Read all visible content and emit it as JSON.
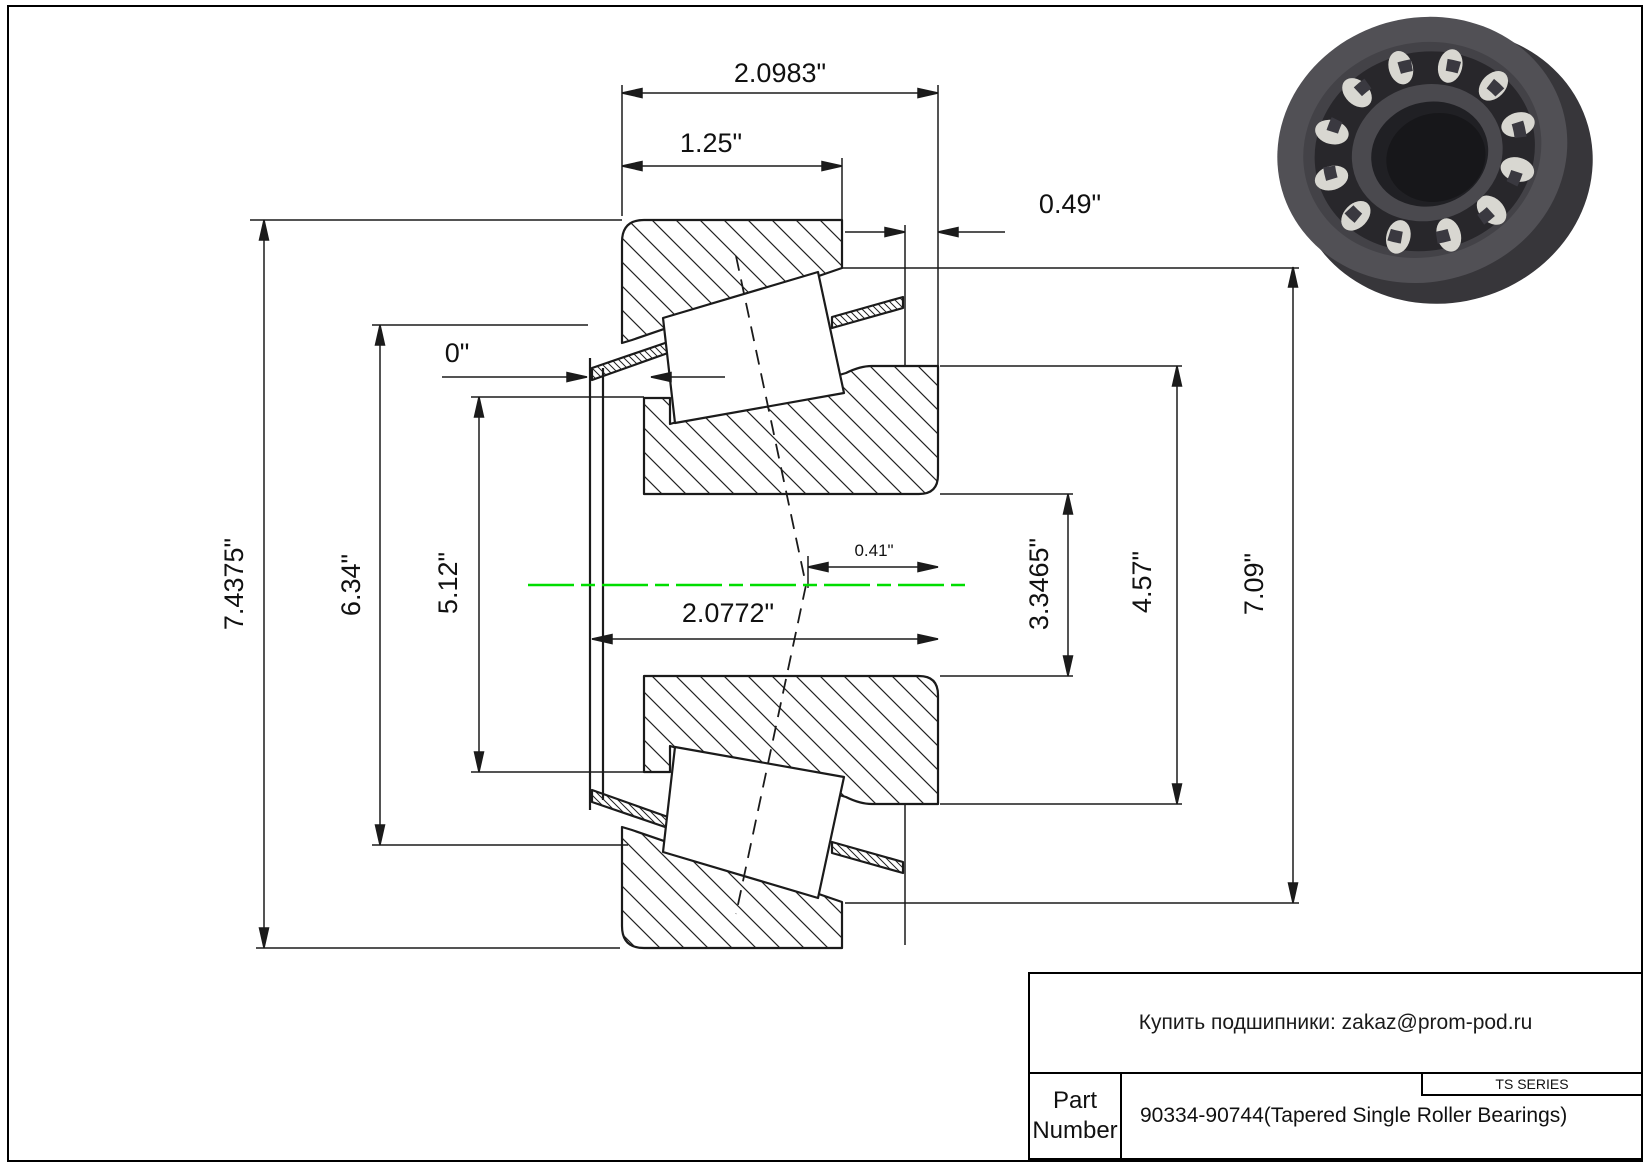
{
  "page": {
    "bg": "#ffffff",
    "border_color": "#000000"
  },
  "drawing": {
    "centerline_color": "#00dd00",
    "line_color": "#1b1b1b",
    "dims": {
      "overall_width": "2.0983\"",
      "cup_width": "1.25\"",
      "cage_standout": "0.49\"",
      "front_standout": "0\"",
      "outer_diameter": "7.4375\"",
      "flange_diameter": "6.34\"",
      "front_face_diameter": "5.12\"",
      "cone_width": "2.0772\"",
      "effective_center": "0.41\"",
      "bore_diameter": "3.3465\"",
      "rib_diameter": "4.57\"",
      "cup_face_diameter": "7.09\""
    }
  },
  "title_block": {
    "supplier_note": "Купить подшипники: zakaz@prom-pod.ru",
    "series_label": "TS SERIES",
    "part_number_label": "Part Number",
    "part_number_value": "90334-90744(Tapered Single Roller Bearings)"
  }
}
